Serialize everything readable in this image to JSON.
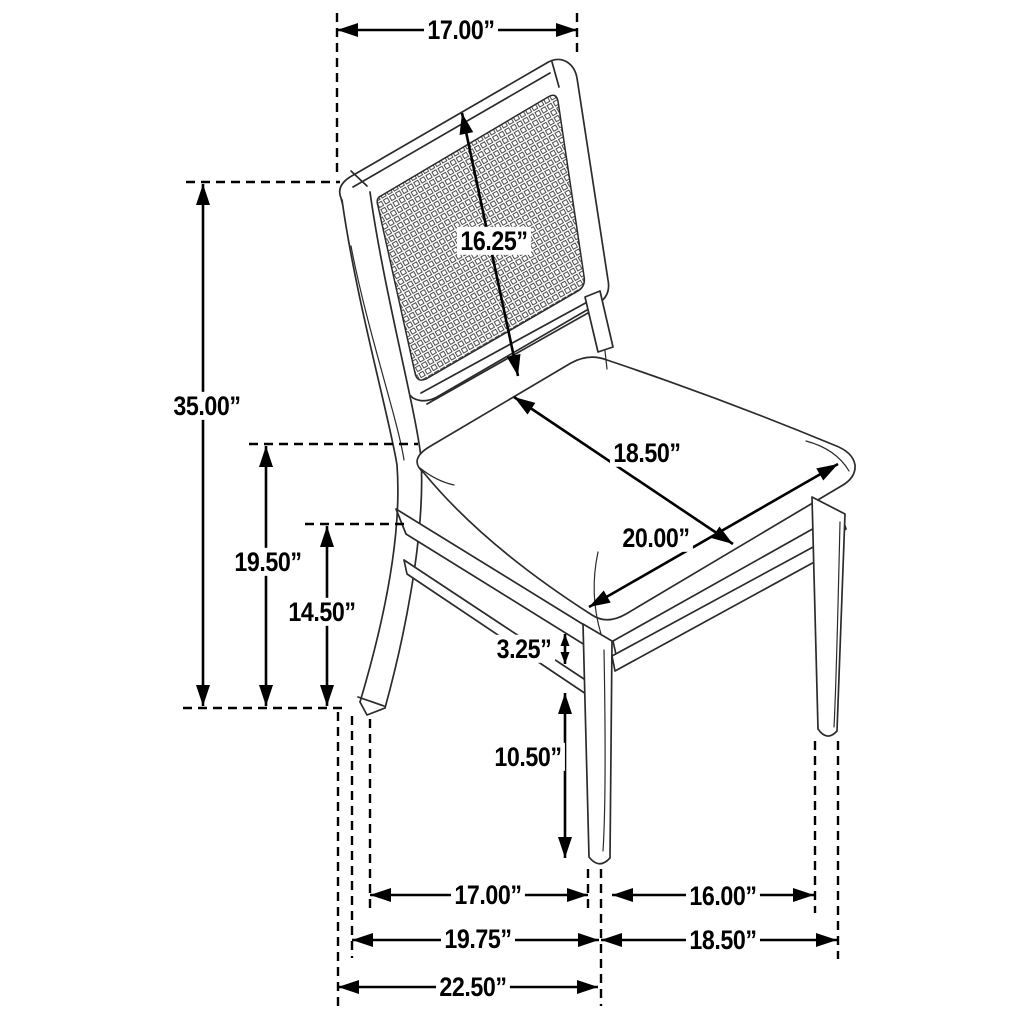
{
  "page": {
    "background_color": "#ffffff",
    "line_color": "#000000",
    "unit": "inches"
  },
  "dimensions": {
    "top_width": {
      "label": "17.00”"
    },
    "back_panel_height": {
      "label": "16.25”"
    },
    "overall_height": {
      "label": "35.00”"
    },
    "seat_surface_depth": {
      "label": "18.50”"
    },
    "seat_surface_width": {
      "label": "20.00”"
    },
    "floor_to_seat_top": {
      "label": "19.50”"
    },
    "floor_to_apron": {
      "label": "14.50”"
    },
    "stretcher_height": {
      "label": "3.25”"
    },
    "floor_to_stretcher": {
      "label": "10.50”"
    },
    "leg_span_inner_depth": {
      "label": "17.00”"
    },
    "front_leg_span": {
      "label": "16.00”"
    },
    "leg_span_depth": {
      "label": "19.75”"
    },
    "front_width": {
      "label": "18.50”"
    },
    "overall_depth": {
      "label": "22.50”"
    }
  }
}
